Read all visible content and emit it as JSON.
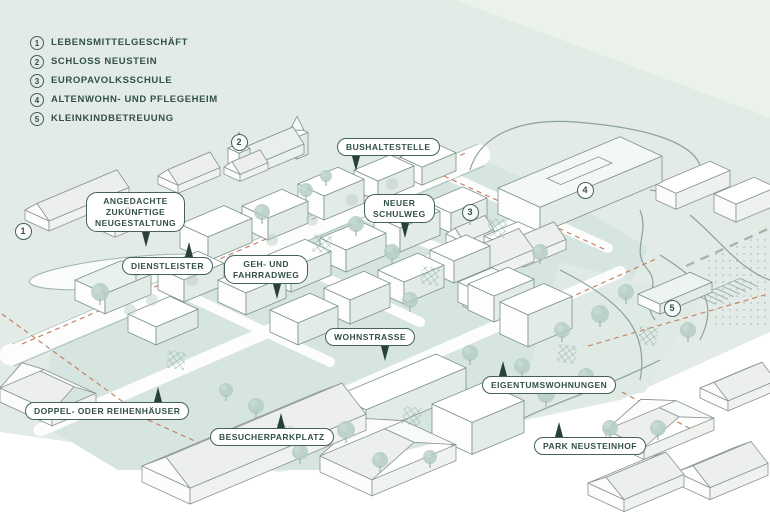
{
  "legend": {
    "items": [
      {
        "num": "1",
        "label": "LEBENSMITTELGESCHÄFT"
      },
      {
        "num": "2",
        "label": "SCHLOSS NEUSTEIN"
      },
      {
        "num": "3",
        "label": "EUROPAVOLKSSCHULE"
      },
      {
        "num": "4",
        "label": "ALTENWOHN- UND PFLEGEHEIM"
      },
      {
        "num": "5",
        "label": "KLEINKINDBETREUUNG"
      }
    ]
  },
  "map_labels": [
    {
      "id": "bushaltestelle",
      "text": "BUSHALTESTELLE"
    },
    {
      "id": "angedachte-neugestaltung",
      "text": "ANGEDACHTE\nZUKÜNFTIGE\nNEUGESTALTUNG"
    },
    {
      "id": "dienstleister",
      "text": "DIENSTLEISTER"
    },
    {
      "id": "neuer-schulweg",
      "text": "NEUER\nSCHULWEG"
    },
    {
      "id": "geh-und-fahrradweg",
      "text": "GEH- UND\nFAHRRADWEG"
    },
    {
      "id": "wohnstrasse",
      "text": "WOHNSTRASSE"
    },
    {
      "id": "eigentumswohnungen",
      "text": "EIGENTUMSWOHNUNGEN"
    },
    {
      "id": "doppel-oder-reihenhaeuser",
      "text": "DOPPEL- ODER REIHENHÄUSER"
    },
    {
      "id": "besucherparkplatz",
      "text": "BESUCHERPARKPLATZ"
    },
    {
      "id": "park-neusteinhof",
      "text": "PARK NEUSTEINHOF"
    }
  ],
  "map_markers": [
    {
      "num": "1"
    },
    {
      "num": "2"
    },
    {
      "num": "3"
    },
    {
      "num": "4"
    },
    {
      "num": "5"
    }
  ],
  "colors": {
    "text_green": "#33504a",
    "border_green": "#46615a",
    "pointer_green": "#27413a",
    "background_sage": "#e2ebe5",
    "site_teal": "#d6e5e0",
    "tree_teal": "#b5cdc6",
    "boundary_red": "#c57a5a"
  }
}
